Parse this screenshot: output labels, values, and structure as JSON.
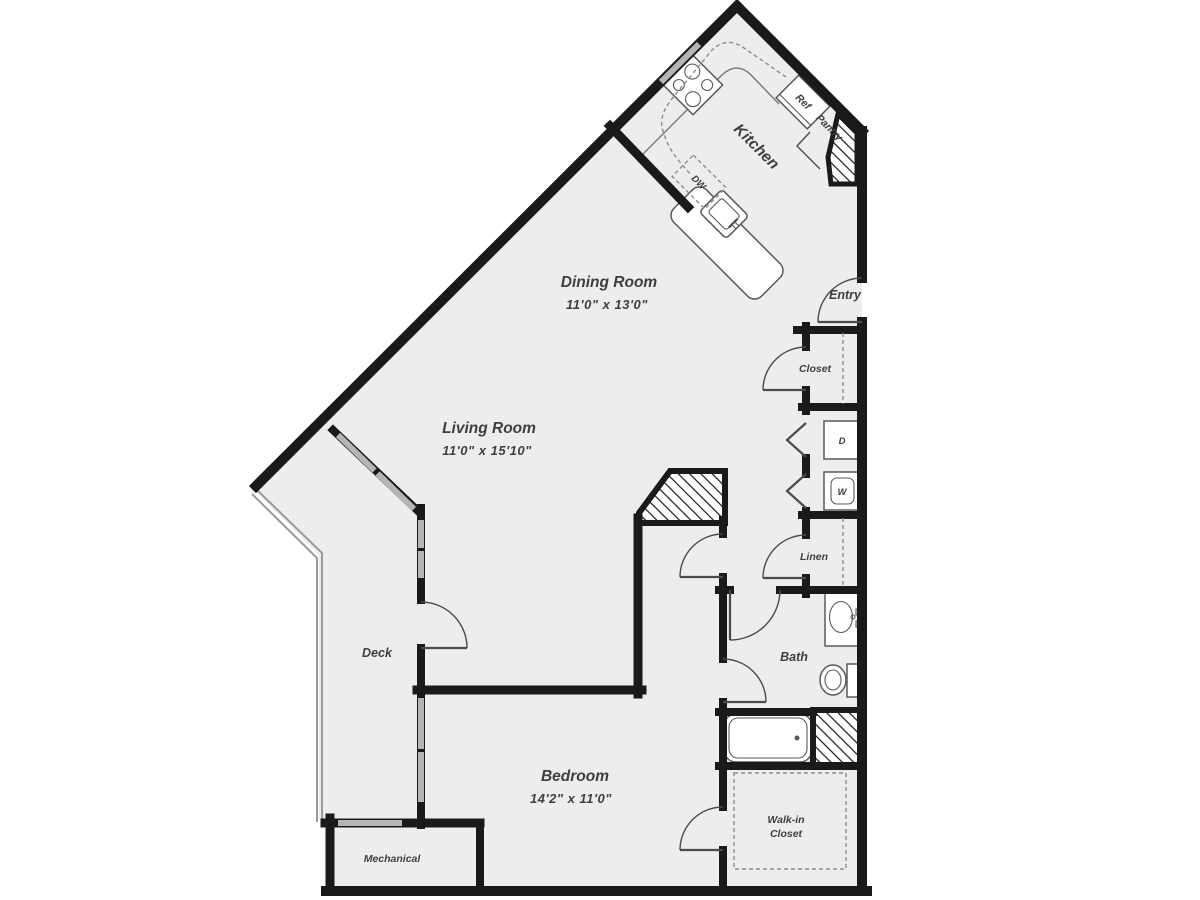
{
  "floorplan": {
    "rooms": {
      "kitchen": {
        "label": "Kitchen"
      },
      "dining_room": {
        "label": "Dining Room",
        "dimensions": "11'0\" x 13'0\""
      },
      "living_room": {
        "label": "Living Room",
        "dimensions": "11'0\" x 15'10\""
      },
      "bedroom": {
        "label": "Bedroom",
        "dimensions": "14'2\" x 11'0\""
      },
      "bath": {
        "label": "Bath"
      },
      "entry": {
        "label": "Entry"
      },
      "closet": {
        "label": "Closet"
      },
      "linen": {
        "label": "Linen"
      },
      "walk_in_closet": {
        "label_line1": "Walk-in",
        "label_line2": "Closet"
      },
      "pantry": {
        "label": "Pantry"
      },
      "deck": {
        "label": "Deck"
      },
      "mechanical": {
        "label": "Mechanical"
      }
    },
    "appliances": {
      "refrigerator": {
        "label": "Ref"
      },
      "dishwasher": {
        "label": "DW"
      },
      "dryer": {
        "label": "D"
      },
      "washer": {
        "label": "W"
      }
    },
    "colors": {
      "wall": "#1a1a1a",
      "floor": "#ededee",
      "window": "#b5b5b5",
      "fixture_outline": "#5a5a5a",
      "label_text": "#3f3f3f",
      "background": "#ffffff"
    }
  }
}
